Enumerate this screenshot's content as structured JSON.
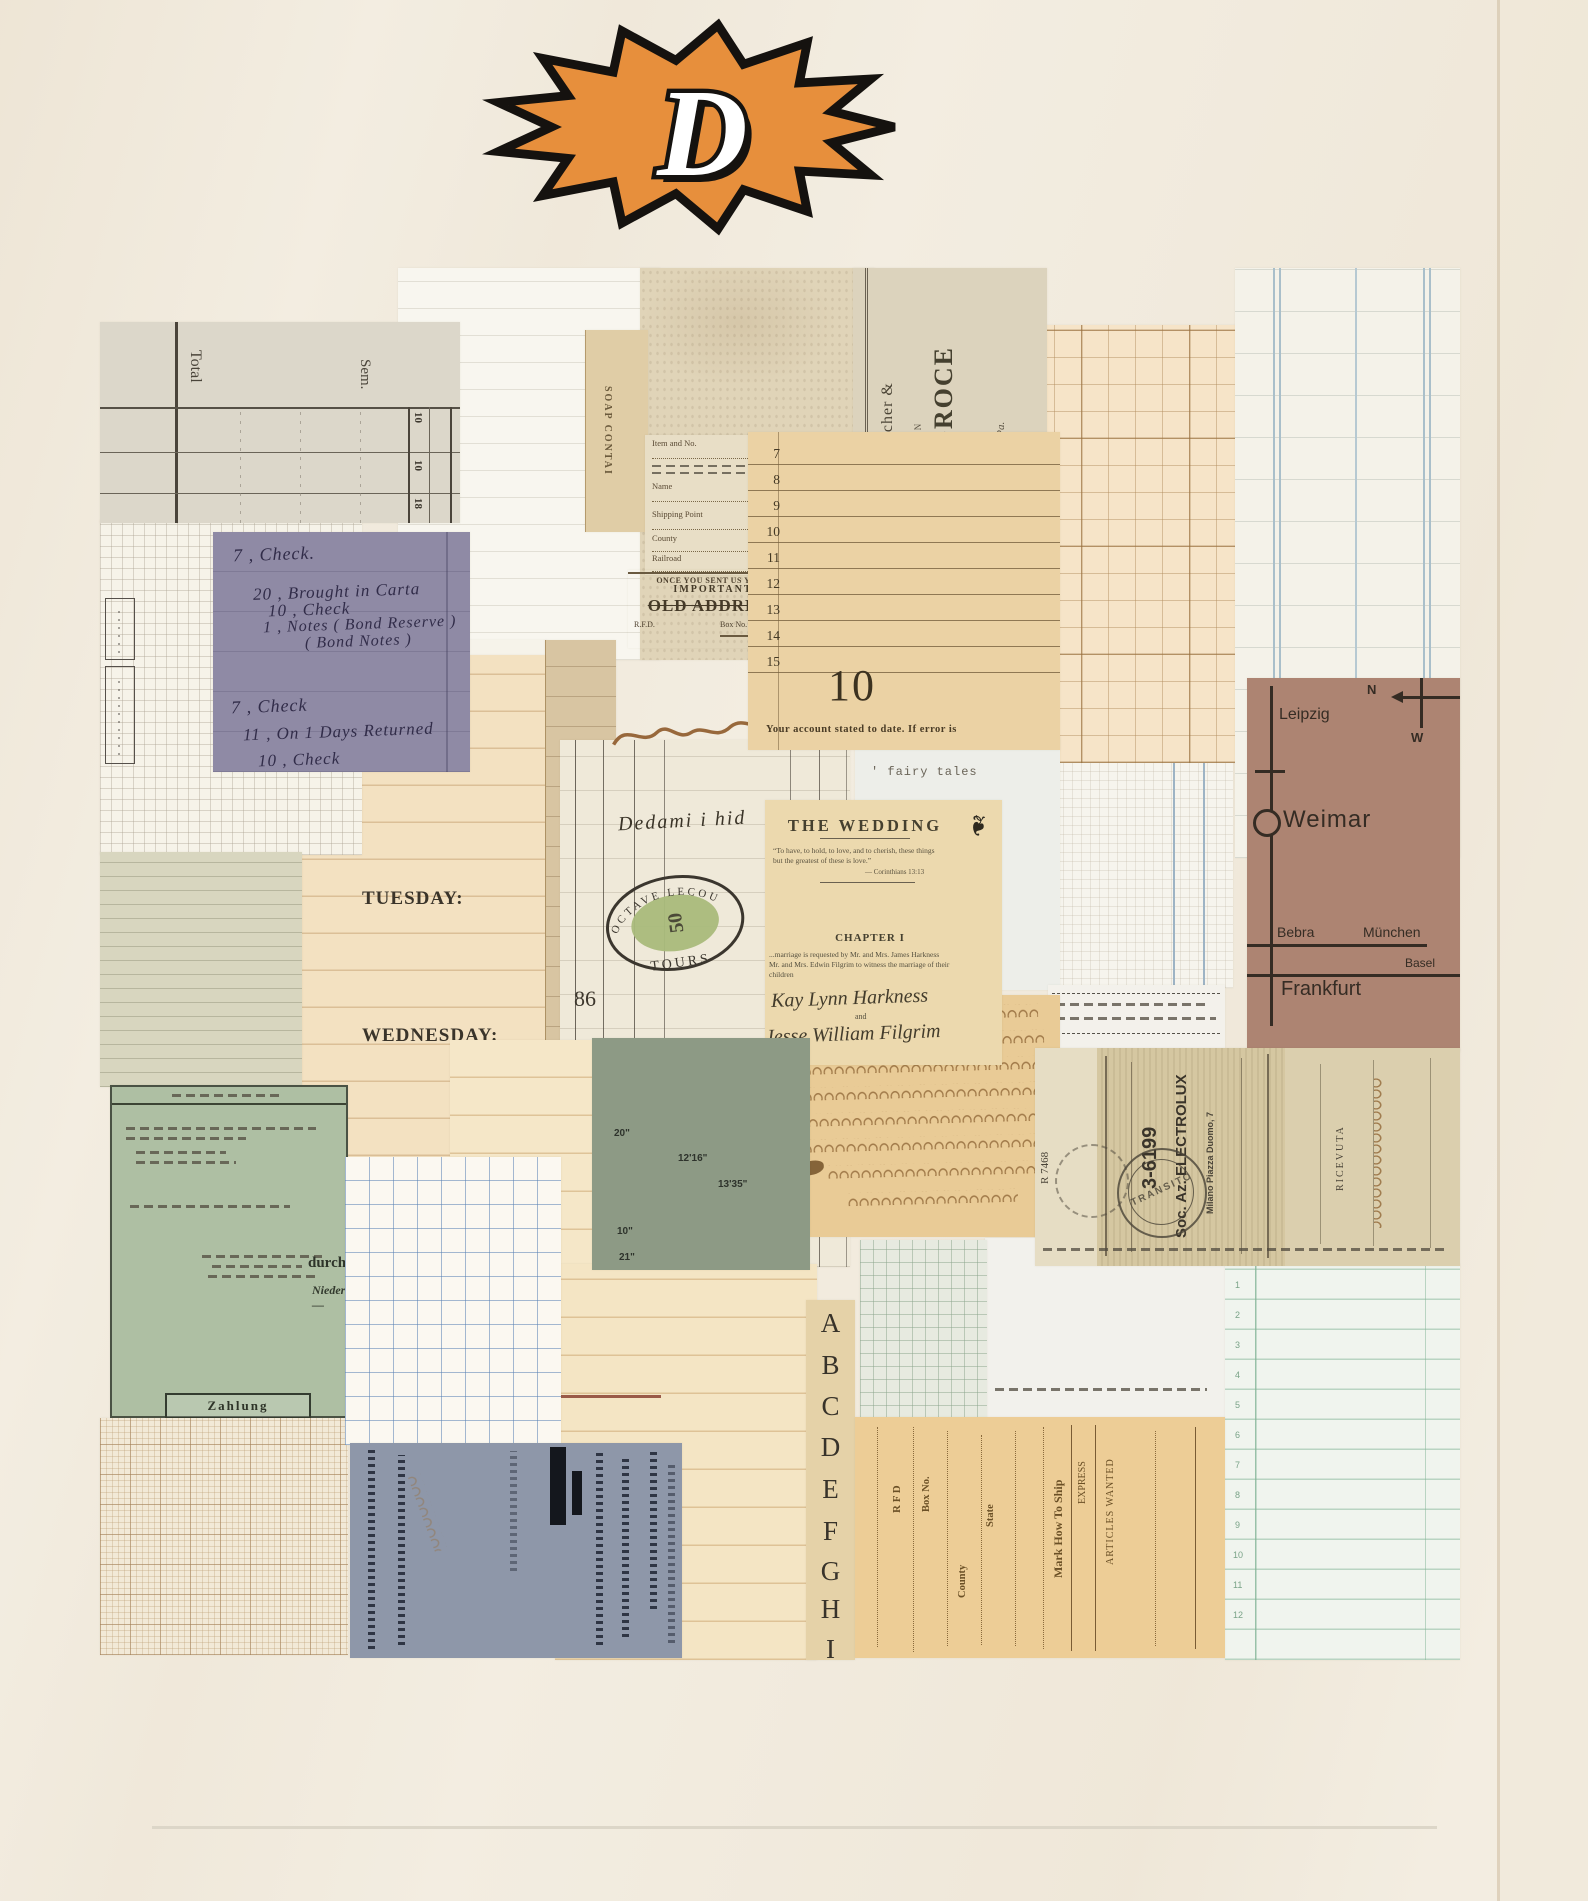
{
  "page": {
    "background": "#f3ede1",
    "accent_orange": "#e78f3c",
    "outline_black": "#15120f"
  },
  "badge": {
    "letter": "D"
  },
  "collage": {
    "ledger_top_left": {
      "total": "Total",
      "sem": "Sem.",
      "nums": [
        "10",
        "10",
        "18"
      ]
    },
    "soap_strip": {
      "text": "SOAP CONTAI"
    },
    "shipping_form": {
      "item": "Item and No.",
      "name": "Name",
      "shipping_point": "Shipping Point",
      "county": "County",
      "railroad": "Railroad"
    },
    "old_address": {
      "line1": "ONCE YOU SENT US YOUR",
      "line2": "IMPORTANT",
      "line3": "OLD ADDRESS",
      "line4a": "R.F.D.",
      "line4b": "Box No."
    },
    "grocer": {
      "line1": "Applebee, Fischer &",
      "line2": "DEALERS IN",
      "line3": "FAMILY GROCE",
      "line4": "Arendtsville, Pa."
    },
    "statement": {
      "rows": [
        "7",
        "8",
        "9",
        "10",
        "11",
        "12",
        "13",
        "14",
        "15"
      ],
      "big_number": "10",
      "footer": "Your account stated to date. If error is"
    },
    "purple_note": {
      "entries": [
        "7 ,   Check.",
        "20 ,  Brought in Carta",
        "10 ,       Check",
        "1  ,  Notes ( Bond Reserve )",
        "( Bond Notes )",
        "7 ,   Check",
        "11 ,  On 1 Days Returned",
        "10 ,       Check"
      ]
    },
    "diary": {
      "tuesday": "TUESDAY:",
      "wednesday": "WEDNESDAY:"
    },
    "central_ledger": {
      "page_number": "86",
      "handwriting": "Dedami  i  hid",
      "stamp_top": "OCTAVE LECOU",
      "stamp_value": "50",
      "stamp_bottom": "TOURS"
    },
    "wedding": {
      "title": "THE WEDDING",
      "ornament": "❧",
      "quote1": "“To have, to hold, to love, and to cherish, these things",
      "quote2": "but the greatest of these is love.”",
      "quote_attr": "— Corinthians 13:13",
      "chapter": "CHAPTER I",
      "para1": "...marriage is requested by Mr. and Mrs. James Harkness",
      "para2": "Mr. and Mrs. Edwin Filgrim to witness the marriage of their",
      "para3": "children",
      "name1": "Kay  Lynn  Harkness",
      "and": "and",
      "name2": "Jesse  William  Filgrim"
    },
    "fairy_tales": {
      "text": "'  fairy tales"
    },
    "map": {
      "leipzig": "Leipzig",
      "n": "N",
      "w": "W",
      "weimar": "Weimar",
      "bebra": "Bebra",
      "muenchen": "München",
      "basel": "Basel",
      "frankfurt": "Frankfurt"
    },
    "electrolux": {
      "serial": "R 7468",
      "number": "3-6199",
      "company": "Soc. Az. ELECTROLUX",
      "address": "Milano  Piazza Duomo, 7",
      "label": "RICEVUTA",
      "stamp": "TRANSITO"
    },
    "sage_card": {
      "m1": "20\"",
      "m2": "12'16\"",
      "m3": "13'35\"",
      "m4": "10\"",
      "m5": "21\""
    },
    "german_receipt": {
      "bold_word": "durch",
      "italic_word": "Nieder—",
      "stamp_box": "Zahlung"
    },
    "order_form": {
      "rfd": "R F D",
      "box_no": "Box No.",
      "state": "State",
      "county": "County",
      "ship": "Mark How To Ship",
      "express": "EXPRESS",
      "articles": "ARTICLES WANTED"
    },
    "alphabet": [
      "A",
      "B",
      "C",
      "D",
      "E",
      "F",
      "G",
      "H",
      "I"
    ],
    "green_ledger": {
      "rows": [
        "1",
        "2",
        "3",
        "4",
        "5",
        "6",
        "7",
        "8",
        "9",
        "10",
        "11",
        "12"
      ]
    }
  }
}
